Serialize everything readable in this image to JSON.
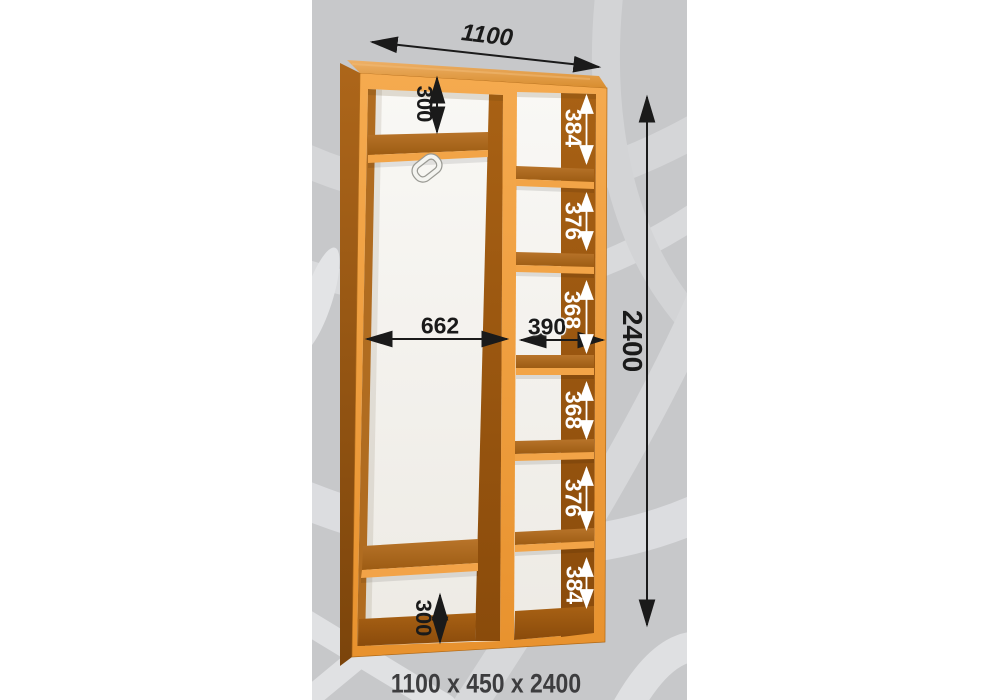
{
  "scene": {
    "caption": "1100 x 450 x 2400",
    "dimensions": {
      "width_top": "1100",
      "height_overall": "2400",
      "left_top_shelf": "300",
      "left_bottom_shelf": "300",
      "left_inner_width": "662",
      "right_inner_width": "390",
      "right_shelves": [
        "384",
        "376",
        "368",
        "368",
        "376",
        "384"
      ]
    },
    "icons": {
      "hanger_bracket": "rod-bracket-icon"
    },
    "colors": {
      "panel_bg": "#c7c8ca",
      "swirl_light": "#d9dadc",
      "wood_front": "#f0a046",
      "wood_top": "#e2a04a",
      "wood_side_dark": "#8a4d0e",
      "interior_white": "#f7f6f3",
      "dimension_black": "#1a1a1a",
      "dimension_white": "#ffffff",
      "caption_color": "#3d3d3f"
    }
  }
}
